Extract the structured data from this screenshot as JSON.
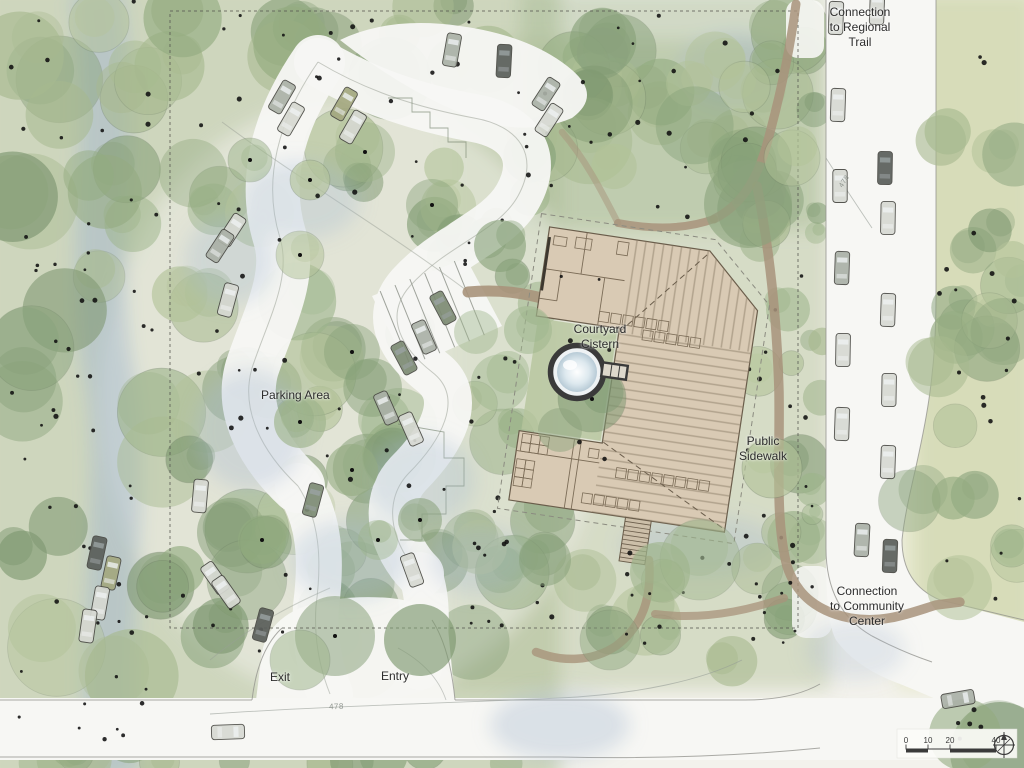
{
  "plan": {
    "labels": {
      "connection_regional_trail": "Connection\nto Regional\nTrail",
      "courtyard_cistern": "Courtyard\nCistern",
      "parking_area": "Parking Area",
      "public_sidewalk": "Public\nSidewalk",
      "connection_community_center": "Connection\nto Community\nCenter",
      "exit": "Exit",
      "entry": "Entry"
    },
    "contour_labels": {
      "bottom_road": "478",
      "right_road": "478"
    },
    "scale_bar": {
      "ticks": [
        "0",
        "10",
        "20",
        "40"
      ]
    },
    "icons": {
      "north_arrow": "north-arrow-compass"
    },
    "colors": {
      "paper": "#f3f2ec",
      "road": "#f7f7f4",
      "building": "#d9cab4",
      "building_line": "#6a5d4b",
      "roof_hatch": "#8a7c66",
      "trail": "#a8937b",
      "boundary": "#52524c",
      "water": "#a4b8cf",
      "label_text": "#2d2d2d",
      "contour_gray": "#969c96",
      "cistern_ring": "#3a3a3a",
      "cistern_water": "#dce8ee",
      "canopy_palette": [
        "#a7b98f",
        "#93ab80",
        "#86a078",
        "#9db48b",
        "#b2c298",
        "#8ba37d",
        "#7d9770"
      ],
      "car_shades": {
        "light": "#d6d8d2",
        "med": "#aab0a6",
        "dark": "#5a5e5a",
        "olive": "#a3a87f",
        "green": "#7c8a74"
      }
    }
  }
}
